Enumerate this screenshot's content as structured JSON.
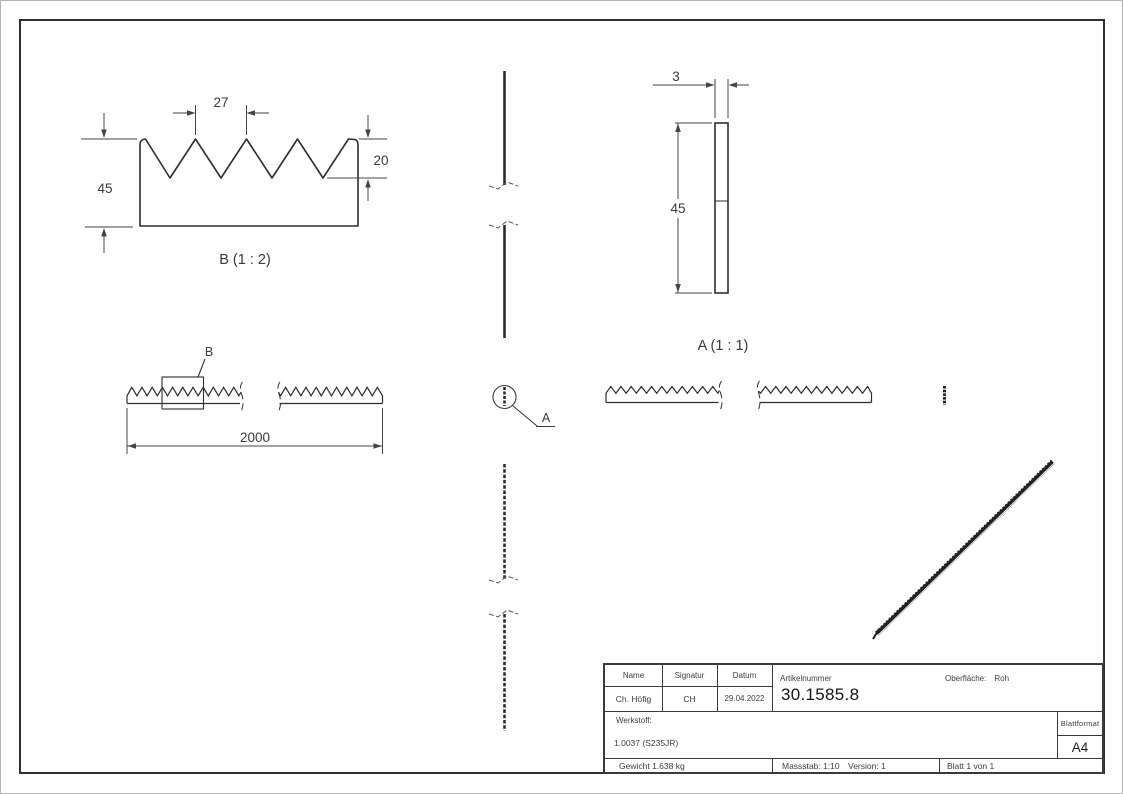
{
  "views": {
    "detail_b": {
      "label": "B (1 : 2)",
      "dim_pitch": "27",
      "dim_tooth_depth": "20",
      "dim_height": "45"
    },
    "section_a": {
      "label": "A (1 : 1)",
      "dim_thickness": "3",
      "dim_height": "45"
    },
    "front_view": {
      "dim_length": "2000",
      "detail_marker_label": "B"
    },
    "section_marker": {
      "label": "A"
    }
  },
  "title_block": {
    "headers": {
      "name": "Name",
      "signatur": "Signatur",
      "datum": "Datum",
      "artikelnummer": "Artikelnummer",
      "oberflaeche_label": "Oberfläche:",
      "oberflaeche_value": "Roh",
      "werkstoff": "Werkstoff:",
      "blattformat": "Blattformat"
    },
    "values": {
      "name": "Ch. Höfig",
      "signatur": "CH",
      "datum": "29.04.2022",
      "artikelnummer": "30.1585.8",
      "werkstoff": "1.0037 (S235JR)",
      "blattformat": "A4",
      "gewicht": "Gewicht 1.638 kg",
      "massstab": "Massstab: 1:10",
      "version": "Version: 1",
      "blatt": "Blatt 1 von 1"
    }
  },
  "line_color": "#2e2e2e",
  "dim_color": "#444444"
}
